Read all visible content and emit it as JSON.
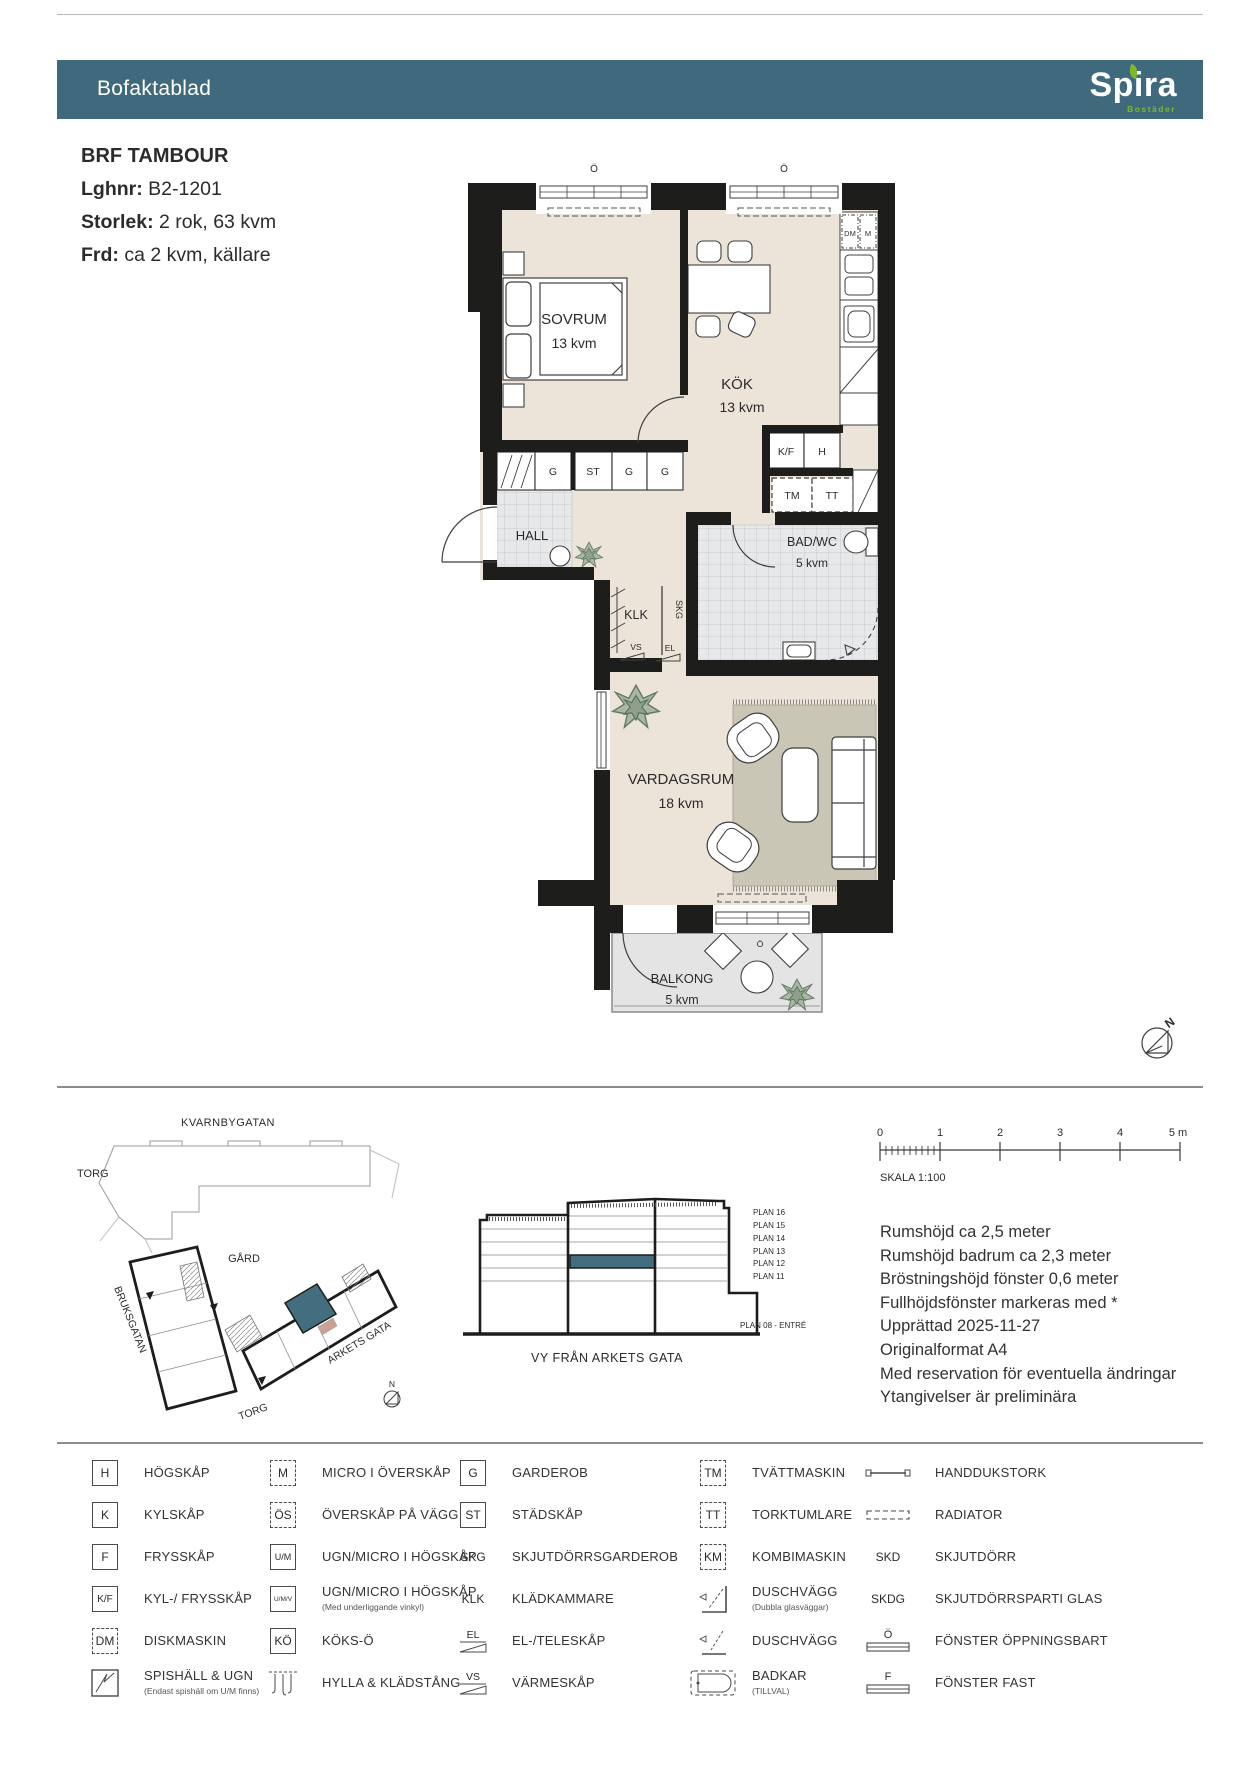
{
  "header": {
    "title": "Bofaktablad",
    "brand": {
      "name": "Spira",
      "sub": "Bostäder"
    }
  },
  "info": {
    "title": "BRF TAMBOUR",
    "rows": [
      {
        "label": "Lghnr:",
        "value": " B2-1201"
      },
      {
        "label": "Storlek:",
        "value": " 2 rok, 63 kvm"
      },
      {
        "label": "Frd:",
        "value": " ca 2 kvm, källare"
      }
    ]
  },
  "floor_plan": {
    "rooms": {
      "sovrum": {
        "name": "SOVRUM",
        "area": "13 kvm"
      },
      "kok": {
        "name": "KÖK",
        "area": "13 kvm"
      },
      "hall": {
        "name": "HALL"
      },
      "klk": {
        "name": "KLK"
      },
      "bad": {
        "name": "BAD/WC",
        "area": "5 kvm"
      },
      "vardagsrum": {
        "name": "VARDAGSRUM",
        "area": "18 kvm"
      },
      "balkong": {
        "name": "BALKONG",
        "area": "5 kvm"
      }
    },
    "labels": {
      "g": "G",
      "st": "ST",
      "kf": "K/F",
      "h": "H",
      "tm": "TM",
      "tt": "TT",
      "dm": "DM",
      "m": "M",
      "skg": "SKG",
      "vs": "VS",
      "el": "EL",
      "window_open": "Ö",
      "north": "N"
    }
  },
  "site_plan": {
    "streets": {
      "kvarnbygatan": "KVARNBYGATAN",
      "torg_left": "TORG",
      "gard": "GÅRD",
      "bruksgatan": "BRUKSGATAN",
      "arkets_gata": "ARKETS GATA",
      "torg_bottom": "TORG"
    },
    "north": "N"
  },
  "elevation": {
    "floors": [
      "PLAN 16",
      "PLAN 15",
      "PLAN 14",
      "PLAN 13",
      "PLAN 12",
      "PLAN 11"
    ],
    "entry": "PLAN 08 - ENTRÉ",
    "caption": "VY FRÅN ARKETS GATA"
  },
  "scale_bar": {
    "ticks": [
      "0",
      "1",
      "2",
      "3",
      "4",
      "5 m"
    ],
    "label": "SKALA 1:100"
  },
  "notes": [
    "Rumshöjd ca 2,5 meter",
    "Rumshöjd badrum ca 2,3 meter",
    "Bröstningshöjd fönster 0,6 meter",
    "Fullhöjdsfönster markeras med *",
    "Upprättad 2025-11-27",
    "Originalformat A4",
    "Med reservation för eventuella ändringar",
    "Ytangivelser är preliminära"
  ],
  "legend": {
    "columns": [
      {
        "items": [
          {
            "key": "H",
            "label": "HÖGSKÅP"
          },
          {
            "key": "K",
            "label": "KYLSKÅP"
          },
          {
            "key": "F",
            "label": "FRYSSKÅP"
          },
          {
            "key": "K/F",
            "label": "KYL-/ FRYSSKÅP"
          },
          {
            "key": "DM",
            "label": "DISKMASKIN"
          },
          {
            "key": "",
            "label": "SPISHÄLL & UGN",
            "caption": "(Endast spishäll om U/M finns)"
          }
        ]
      },
      {
        "items": [
          {
            "key": "M",
            "label": "MICRO I ÖVERSKÅP"
          },
          {
            "key": "ÖS",
            "label": "ÖVERSKÅP PÅ VÄGG"
          },
          {
            "key": "U/M",
            "label": "UGN/MICRO I HÖGSKÅP"
          },
          {
            "key": "U/M/V",
            "label": "UGN/MICRO I HÖGSKÅP",
            "caption": "(Med underliggande vinkyl)"
          },
          {
            "key": "KÖ",
            "label": "KÖKS-Ö"
          },
          {
            "key": "",
            "label": "HYLLA & KLÄDSTÅNG"
          }
        ]
      },
      {
        "items": [
          {
            "key": "G",
            "label": "GARDEROB"
          },
          {
            "key": "ST",
            "label": "STÄDSKÅP"
          },
          {
            "key": "SKG",
            "label": "SKJUTDÖRRSGARDEROB"
          },
          {
            "key": "KLK",
            "label": "KLÄDKAMMARE"
          },
          {
            "key": "EL",
            "label": "EL-/TELESKÅP"
          },
          {
            "key": "VS",
            "label": "VÄRMESKÅP"
          }
        ]
      },
      {
        "items": [
          {
            "key": "TM",
            "label": "TVÄTTMASKIN"
          },
          {
            "key": "TT",
            "label": "TORKTUMLARE"
          },
          {
            "key": "KM",
            "label": "KOMBIMASKIN"
          },
          {
            "key": "",
            "label": "DUSCHVÄGG",
            "caption": "(Dubbla glasväggar)"
          },
          {
            "key": "",
            "label": "DUSCHVÄGG"
          },
          {
            "key": "",
            "label": "BADKAR",
            "caption": "(TILLVAL)"
          }
        ]
      },
      {
        "items": [
          {
            "key": "",
            "label": "HANDDUKSTORK"
          },
          {
            "key": "",
            "label": "RADIATOR"
          },
          {
            "key": "SKD",
            "label": "SKJUTDÖRR"
          },
          {
            "key": "SKDG",
            "label": "SKJUTDÖRRSPARTI GLAS"
          },
          {
            "key": "Ö",
            "label": "FÖNSTER ÖPPNINGSBART"
          },
          {
            "key": "F",
            "label": "FÖNSTER FAST"
          }
        ]
      }
    ]
  },
  "colors": {
    "header_teal": "#3f6a7d",
    "brand_green": "#7cb928",
    "unit_highlight": "#436e80",
    "floor_beige": "#ece3d9",
    "wall": "#1d1d1b"
  }
}
